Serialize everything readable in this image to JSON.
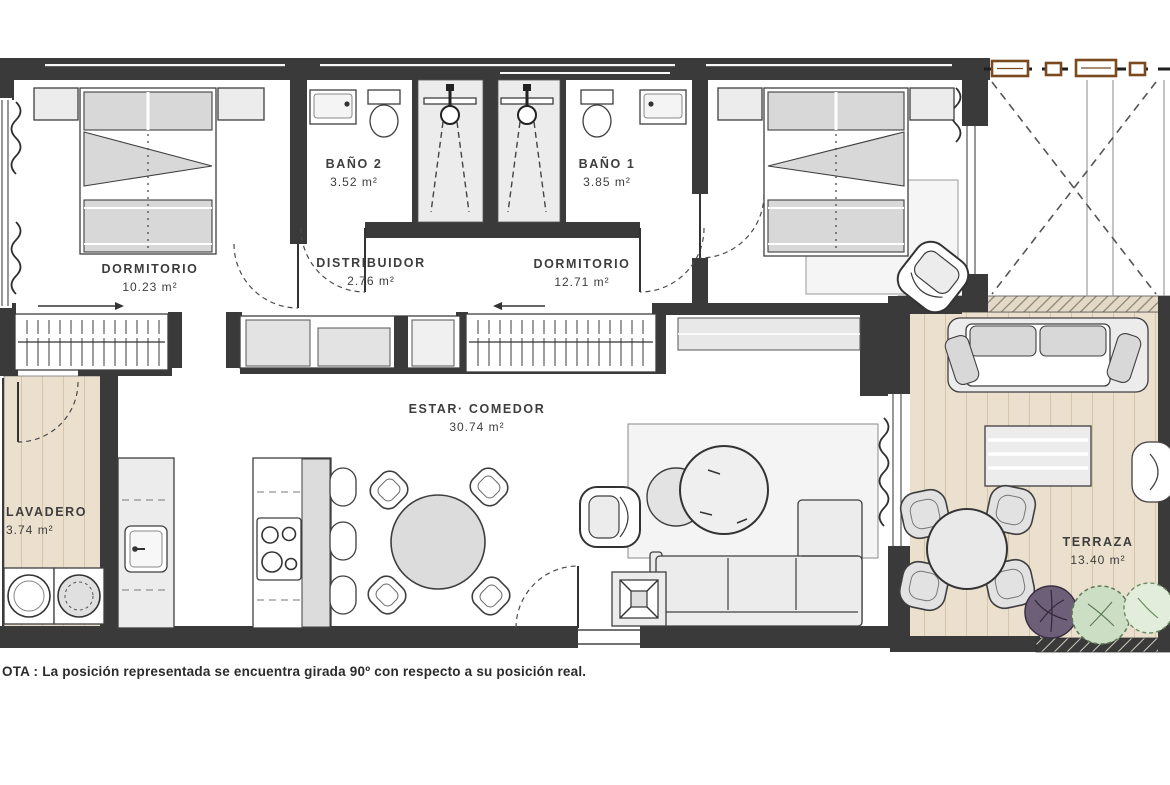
{
  "rooms": [
    {
      "id": "dormitorio-1",
      "name": "DORMITORIO",
      "area": "10.23 m²"
    },
    {
      "id": "bano-2",
      "name": "BAÑO 2",
      "area": "3.52 m²"
    },
    {
      "id": "bano-1",
      "name": "BAÑO 1",
      "area": "3.85 m²"
    },
    {
      "id": "distribuidor",
      "name": "DISTRIBUIDOR",
      "area": "2.76 m²"
    },
    {
      "id": "dormitorio-2",
      "name": "DORMITORIO",
      "area": "12.71 m²"
    },
    {
      "id": "estar-comedor",
      "name": "ESTAR· COMEDOR",
      "area": "30.74 m²"
    },
    {
      "id": "lavadero",
      "name": "LAVADERO",
      "area": "3.74 m²"
    },
    {
      "id": "terraza",
      "name": "TERRAZA",
      "area": "13.40 m²"
    }
  ],
  "note": "OTA : La posición representada se encuentra girada 90º con respecto a su posición real.",
  "colors": {
    "wall": "#3a3a3a",
    "wood_deck": "#eae0cd",
    "furniture_light": "#ececec",
    "furniture_mid": "#d8d8d8",
    "pergola_beam": "#7a4a1e",
    "plant_purple": "#6e5f78",
    "plant_green": "#ccdfc5"
  }
}
